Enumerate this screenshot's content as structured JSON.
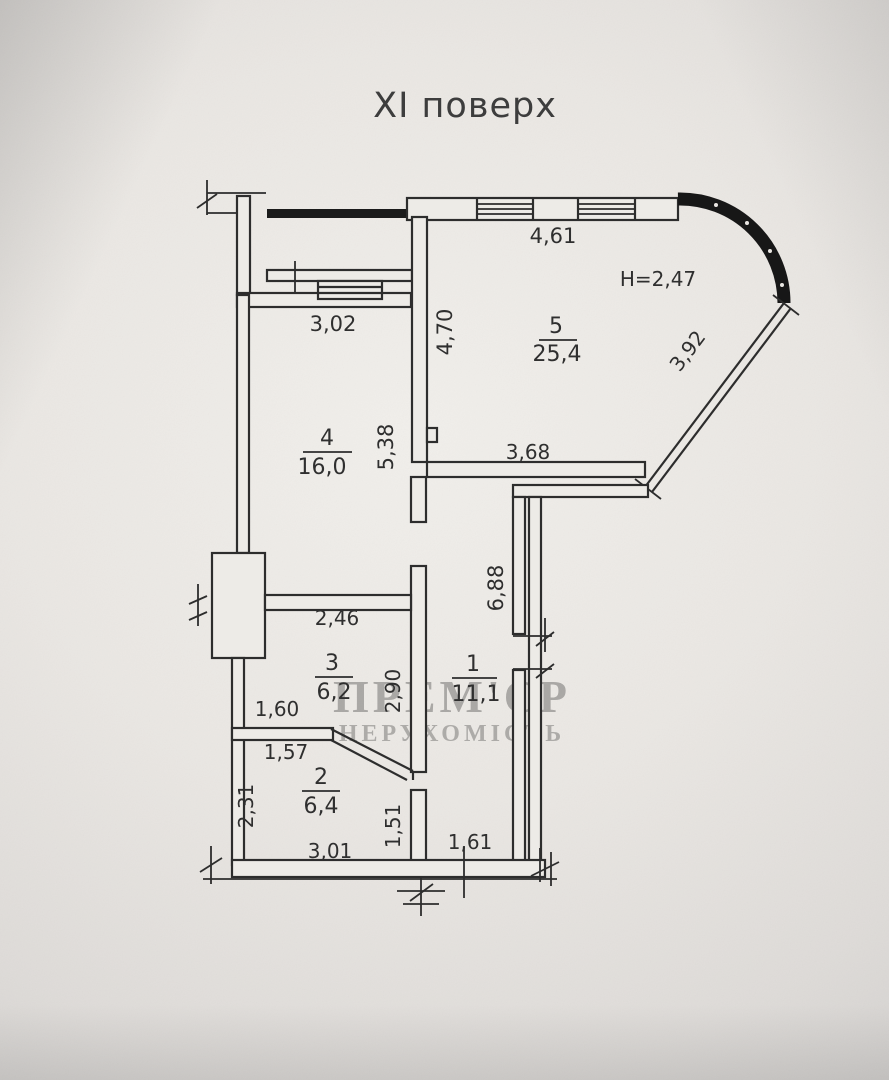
{
  "title": "XI поверх",
  "ceiling_height": "H=2,47",
  "watermark": {
    "line1": "ПРЕМ'ЄР",
    "line2": "НЕРУХОМІСТЬ"
  },
  "rooms": {
    "r1": {
      "number": "1",
      "area": "11,1"
    },
    "r2": {
      "number": "2",
      "area": "6,4"
    },
    "r3": {
      "number": "3",
      "area": "6,2"
    },
    "r4": {
      "number": "4",
      "area": "16,0"
    },
    "r5": {
      "number": "5",
      "area": "25,4"
    }
  },
  "dimensions": {
    "top_window": "4,61",
    "room4_width": "3,02",
    "room5_left_height": "4,70",
    "room4_height": "5,38",
    "bay_diagonal": "3,92",
    "room5_bottom": "3,68",
    "room3_top": "2,46",
    "room1_height": "6,88",
    "room3_height": "2,90",
    "hall_segment": "1,60",
    "room2_top": "1,57",
    "room2_left": "2,31",
    "room2_right": "1,51",
    "room2_bottom": "3,01",
    "room1_bottom": "1,61"
  },
  "colors": {
    "ink": "#2d2d2d",
    "paper": "#e9e6e2",
    "watermark": "#8e8e8e"
  }
}
